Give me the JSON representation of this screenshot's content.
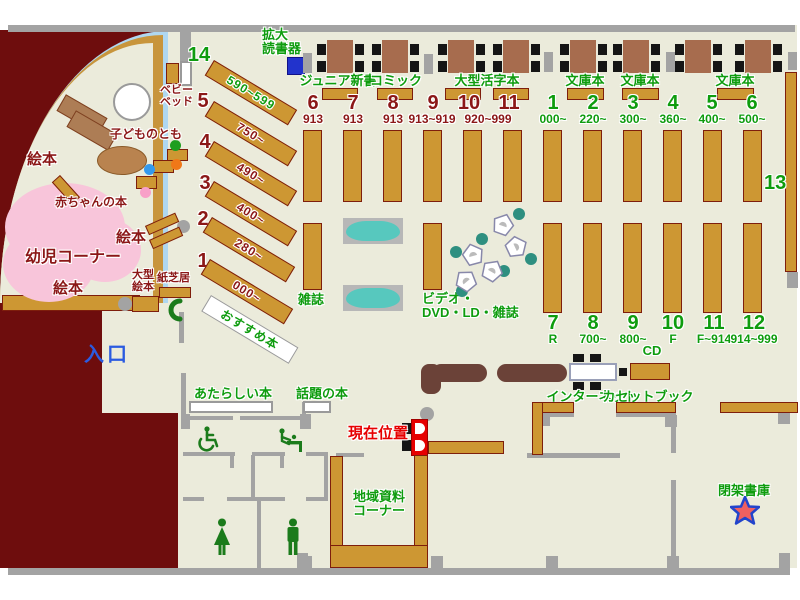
{
  "palette": {
    "floor": "#EBEBDB",
    "outside": "#6E0D0D",
    "shelf": "#CD9733",
    "shelf_border": "#7E1E0C",
    "wall": "#A3A3A3",
    "green_text": "#0E9C0E",
    "darkred_text": "#8B1717",
    "blue_text": "#2B5BE0",
    "alert_red": "#E60000",
    "window_blue": "#AFD7F0",
    "pink_area": "#F8C5DA",
    "counter": "#6B4238",
    "teal_seat": "#2E8F80",
    "rack_teal": "#57C8BE"
  },
  "entrance_label": "入口",
  "current_location_label": "現在位置",
  "magnifier": {
    "line1": "拡大",
    "line2": "読書器"
  },
  "children": {
    "area_label": "幼児コーナー",
    "ehon_left": "絵本",
    "ehon_mid": "絵本",
    "ehon_bottom": "絵本",
    "baby_books": "赤ちゃんの本",
    "kodomo_no_tomo": "子どものとも",
    "baby_bed": {
      "line1": "ベビー",
      "line2": "ベッド"
    },
    "large_ehon": {
      "line1": "大型",
      "line2": "絵本"
    },
    "kamishibai": "紙芝居"
  },
  "diagonal": {
    "rows": [
      {
        "no": "14",
        "range": "590~599"
      },
      {
        "no": "5",
        "range": "750~"
      },
      {
        "no": "4",
        "range": "490~"
      },
      {
        "no": "3",
        "range": "400~"
      },
      {
        "no": "2",
        "range": "280~"
      },
      {
        "no": "1",
        "range": "000~"
      }
    ],
    "recommended": "おすすめ本"
  },
  "top_sections": [
    {
      "label": "ジュニア新書"
    },
    {
      "label": "コミック"
    },
    {
      "label": "大型活字本"
    },
    {
      "label": "文庫本"
    },
    {
      "label": "文庫本"
    },
    {
      "label": "文庫本"
    }
  ],
  "red_stacks": [
    {
      "no": "6",
      "range": "913"
    },
    {
      "no": "7",
      "range": "913"
    },
    {
      "no": "8",
      "range": "913"
    },
    {
      "no": "9",
      "range": "913~919"
    },
    {
      "no": "10",
      "range": "920~999"
    },
    {
      "no": "11",
      "range": ""
    }
  ],
  "green_stacks_top": [
    {
      "no": "1",
      "range": "000~"
    },
    {
      "no": "2",
      "range": "220~"
    },
    {
      "no": "3",
      "range": "300~"
    },
    {
      "no": "4",
      "range": "360~"
    },
    {
      "no": "5",
      "range": "400~"
    },
    {
      "no": "6",
      "range": "500~"
    }
  ],
  "green_stacks_bottom": [
    {
      "no": "7",
      "range": "R"
    },
    {
      "no": "8",
      "range": "700~"
    },
    {
      "no": "9",
      "range": "800~"
    },
    {
      "no": "10",
      "range": "F"
    },
    {
      "no": "11",
      "range": "F~914"
    },
    {
      "no": "12",
      "range": "914~999"
    }
  ],
  "stack13": "13",
  "magazine": {
    "zasshi": "雑誌",
    "av_line1": "ビデオ・",
    "av_line2": "DVD・LD・雑誌"
  },
  "services": {
    "cd": "CD",
    "internet": "インターネット",
    "cassette_book": "カセットブック",
    "closed_stacks": "閉架書庫",
    "regional": {
      "line1": "地域資料",
      "line2": "コーナー"
    },
    "new_books": "あたらしい本",
    "topic_books": "話題の本"
  }
}
